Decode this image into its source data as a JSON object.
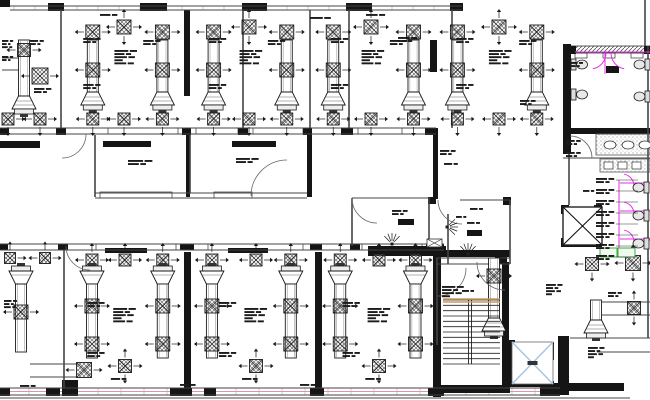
{
  "drawing": {
    "canvas": {
      "w": 650,
      "h": 400,
      "background": "#ffffff"
    },
    "colors": {
      "ink": "#1a1a1a",
      "wall": "#151515",
      "line": "#444444",
      "thin": "#777777",
      "magenta": "#e82de8",
      "green": "#3fa54a",
      "greenFill": "#effaef",
      "elevatorBlue": "#a9c6e4",
      "tan": "#c79b62",
      "pink": "#e48fb4",
      "hatch": "#6a6a6a",
      "stipple": "#999999",
      "white": "#ffffff"
    },
    "plan": {
      "blackRects": [
        [
          0,
          0,
          10,
          7
        ],
        [
          48,
          3,
          16,
          8
        ],
        [
          140,
          3,
          27,
          8
        ],
        [
          242,
          3,
          25,
          8
        ],
        [
          346,
          3,
          26,
          8
        ],
        [
          450,
          3,
          13,
          8
        ],
        [
          184,
          10,
          6,
          86
        ],
        [
          563,
          44,
          8,
          110
        ],
        [
          430,
          40,
          7,
          32
        ],
        [
          0,
          128,
          9,
          7
        ],
        [
          56,
          128,
          10,
          7
        ],
        [
          182,
          128,
          9,
          7
        ],
        [
          238,
          128,
          10,
          7
        ],
        [
          303,
          128,
          9,
          7
        ],
        [
          341,
          128,
          12,
          7
        ],
        [
          425,
          128,
          11,
          7
        ],
        [
          0,
          141,
          40,
          7
        ],
        [
          103,
          141,
          48,
          6
        ],
        [
          232,
          141,
          44,
          6
        ],
        [
          186,
          135,
          4,
          62
        ],
        [
          307,
          133,
          5,
          64
        ],
        [
          433,
          128,
          5,
          71
        ],
        [
          368,
          246,
          78,
          10
        ],
        [
          428,
          197,
          8,
          7
        ],
        [
          503,
          197,
          8,
          8
        ],
        [
          495,
          255,
          12,
          9
        ],
        [
          0,
          244,
          8,
          6
        ],
        [
          58,
          244,
          10,
          6
        ],
        [
          180,
          244,
          14,
          6
        ],
        [
          310,
          244,
          12,
          6
        ],
        [
          350,
          244,
          10,
          6
        ],
        [
          426,
          244,
          18,
          6
        ],
        [
          105,
          248,
          42,
          5
        ],
        [
          228,
          248,
          40,
          5
        ],
        [
          184,
          252,
          7,
          136
        ],
        [
          315,
          252,
          7,
          140
        ],
        [
          433,
          250,
          8,
          147
        ],
        [
          433,
          250,
          77,
          7
        ],
        [
          502,
          262,
          7,
          130
        ],
        [
          436,
          385,
          74,
          8
        ],
        [
          508,
          340,
          7,
          46
        ],
        [
          508,
          381,
          46,
          6
        ],
        [
          510,
          342,
          18,
          5
        ],
        [
          547,
          342,
          7,
          18
        ],
        [
          558,
          336,
          11,
          59
        ],
        [
          540,
          383,
          84,
          8
        ],
        [
          561,
          205,
          8,
          9
        ],
        [
          594,
          205,
          8,
          9
        ],
        [
          561,
          238,
          8,
          9
        ],
        [
          563,
          240,
          39,
          7
        ],
        [
          563,
          128,
          87,
          6
        ],
        [
          0,
          388,
          10,
          8
        ],
        [
          46,
          388,
          14,
          8
        ],
        [
          62,
          380,
          16,
          16
        ],
        [
          170,
          388,
          22,
          8
        ],
        [
          204,
          388,
          12,
          8
        ],
        [
          310,
          388,
          14,
          8
        ],
        [
          428,
          388,
          16,
          8
        ],
        [
          540,
          388,
          20,
          8
        ],
        [
          570,
          46,
          6,
          8
        ],
        [
          644,
          46,
          6,
          8
        ],
        [
          606,
          66,
          13,
          7
        ],
        [
          398,
          219,
          16,
          6
        ],
        [
          467,
          230,
          15,
          6
        ]
      ],
      "hatchRects": [
        [
          570,
          46,
          80,
          7
        ]
      ],
      "vlines": [
        [
          61,
          10,
          128
        ],
        [
          243,
          10,
          128
        ],
        [
          310,
          10,
          128
        ],
        [
          349,
          10,
          128
        ],
        [
          452,
          10,
          128
        ],
        [
          95,
          135,
          197
        ],
        [
          190,
          135,
          193
        ],
        [
          64,
          250,
          388
        ],
        [
          429,
          198,
          246
        ],
        [
          352,
          198,
          246
        ],
        [
          448,
          214,
          264
        ],
        [
          510,
          200,
          264
        ],
        [
          569,
          152,
          205
        ],
        [
          648,
          46,
          338
        ],
        [
          645,
          0,
          46
        ],
        [
          437,
          258,
          345
        ]
      ],
      "hlines": [
        [
          10,
          6,
          462
        ],
        [
          10,
          10,
          462
        ],
        [
          0,
          128,
          436
        ],
        [
          0,
          134,
          436
        ],
        [
          95,
          193,
          307
        ],
        [
          95,
          198,
          307
        ],
        [
          352,
          198,
          430
        ],
        [
          460,
          200,
          510
        ],
        [
          436,
          258,
          510
        ],
        [
          436,
          264,
          510
        ],
        [
          0,
          244,
          444
        ],
        [
          0,
          250,
          444
        ],
        [
          0,
          388,
          560
        ],
        [
          0,
          395,
          560
        ],
        [
          0,
          398,
          630
        ],
        [
          563,
          158,
          650
        ],
        [
          596,
          134,
          650
        ],
        [
          570,
          338,
          650
        ],
        [
          597,
          352,
          650
        ],
        [
          602,
          302,
          650
        ],
        [
          602,
          315,
          650
        ],
        [
          30,
          364,
          78
        ],
        [
          30,
          377,
          78
        ],
        [
          2,
          58,
          20
        ],
        [
          2,
          70,
          20
        ]
      ],
      "pinkLines": [
        [
          0,
          391.5,
          560
        ]
      ],
      "tickRuns": [
        {
          "y1": 6,
          "y2": 10,
          "x1": 14,
          "x2": 458,
          "step": 21
        },
        {
          "y1": 388,
          "y2": 395,
          "x1": 6,
          "x2": 554,
          "step": 23
        }
      ],
      "windowRects": [
        [
          108,
          128,
          70,
          6
        ],
        [
          196,
          128,
          42,
          6
        ],
        [
          253,
          128,
          50,
          6
        ],
        [
          358,
          128,
          44,
          6
        ],
        [
          96,
          244,
          80,
          6
        ],
        [
          208,
          244,
          95,
          6
        ],
        [
          362,
          244,
          60,
          6
        ],
        [
          100,
          192,
          72,
          6
        ],
        [
          214,
          192,
          38,
          6
        ],
        [
          575,
          53,
          12,
          5
        ],
        [
          603,
          53,
          12,
          5
        ],
        [
          631,
          53,
          12,
          5
        ]
      ],
      "topRooms": [
        {
          "x": 64,
          "w": 120,
          "ducts": [
            0.24,
            0.82
          ]
        },
        {
          "x": 190,
          "w": 118,
          "ducts": [
            0.2,
            0.82
          ]
        },
        {
          "x": 312,
          "w": 118,
          "ducts": [
            0.18,
            0.86
          ]
        },
        {
          "x": 436,
          "w": 126,
          "ducts": [
            0.17,
            0.8
          ]
        }
      ],
      "bottomRooms": [
        {
          "x": 66,
          "w": 118,
          "ducts": [
            0.22,
            0.82
          ]
        },
        {
          "x": 198,
          "w": 116,
          "ducts": [
            0.12,
            0.8
          ]
        },
        {
          "x": 322,
          "w": 114,
          "ducts": [
            0.16,
            0.82
          ]
        }
      ],
      "ducts": [
        {
          "cx": 24,
          "y1": 40,
          "y2": 96,
          "hood": "down"
        },
        {
          "cx": 494,
          "y1": 258,
          "y2": 318,
          "hood": "down"
        },
        {
          "cx": 596,
          "y1": 300,
          "y2": 320,
          "hood": "down"
        },
        {
          "cx": 21,
          "y1": 284,
          "y2": 352,
          "hood": "up"
        }
      ],
      "diffusers": [
        {
          "x": 24,
          "y": 50,
          "s": 13,
          "a": [
            "l",
            "r"
          ]
        },
        {
          "x": 40,
          "y": 76,
          "s": 16,
          "a": [
            "l",
            "r"
          ]
        },
        {
          "x": 8,
          "y": 119,
          "s": 12,
          "a": [
            "r",
            "d"
          ]
        },
        {
          "x": 40,
          "y": 119,
          "s": 12,
          "a": [
            "l",
            "r",
            "d"
          ]
        },
        {
          "x": 10,
          "y": 258,
          "s": 11,
          "a": [
            "r",
            "u"
          ]
        },
        {
          "x": 45,
          "y": 258,
          "s": 11,
          "a": [
            "l",
            "r",
            "u"
          ]
        },
        {
          "x": 21,
          "y": 312,
          "s": 14,
          "a": [
            "l",
            "r"
          ]
        },
        {
          "x": 84,
          "y": 370,
          "s": 15,
          "a": [
            "l",
            "r"
          ]
        },
        {
          "x": 494,
          "y": 276,
          "s": 14,
          "a": [
            "l",
            "r"
          ]
        },
        {
          "x": 592,
          "y": 264,
          "s": 13,
          "a": [
            "l",
            "r",
            "d"
          ]
        },
        {
          "x": 633,
          "y": 263,
          "s": 15,
          "a": [
            "l",
            "r",
            "u",
            "d"
          ]
        },
        {
          "x": 634,
          "y": 308,
          "s": 13,
          "a": [
            "u",
            "d"
          ]
        }
      ],
      "doorArcs": [
        {
          "cx": 90,
          "cy": 246,
          "r": 24,
          "a1": 90,
          "a2": 180
        },
        {
          "cx": 287,
          "cy": 196,
          "r": 36,
          "a1": 180,
          "a2": 270
        },
        {
          "cx": 377,
          "cy": 198,
          "r": 25,
          "a1": 90,
          "a2": 180
        },
        {
          "cx": 462,
          "cy": 200,
          "r": 24,
          "a1": 90,
          "a2": 180
        },
        {
          "cx": 505,
          "cy": 262,
          "r": 28,
          "a1": 90,
          "a2": 180
        },
        {
          "cx": 438,
          "cy": 268,
          "r": 28,
          "a1": 0,
          "a2": 90
        },
        {
          "cx": 570,
          "cy": 158,
          "r": 22,
          "a1": 270,
          "a2": 360
        },
        {
          "cx": 62,
          "cy": 134,
          "r": 24,
          "a1": 0,
          "a2": 90
        }
      ],
      "magentaLines": [
        [
          575,
          52,
          650,
          52
        ],
        [
          605,
          53,
          605,
          74
        ],
        [
          619,
          180,
          619,
          256
        ],
        [
          620,
          183,
          650,
          183
        ],
        [
          620,
          211,
          650,
          211
        ],
        [
          620,
          239,
          650,
          239
        ],
        [
          634,
          246,
          650,
          240
        ]
      ],
      "magentaArcs": [
        {
          "cx": 590,
          "cy": 53,
          "r": 16,
          "a1": 0,
          "a2": 80
        },
        {
          "cx": 627,
          "cy": 53,
          "r": 16,
          "a1": 100,
          "a2": 180
        },
        {
          "cx": 622,
          "cy": 186,
          "r": 12,
          "a1": 280,
          "a2": 360
        },
        {
          "cx": 622,
          "cy": 214,
          "r": 12,
          "a1": 280,
          "a2": 360
        },
        {
          "cx": 622,
          "cy": 242,
          "r": 12,
          "a1": 280,
          "a2": 360
        }
      ],
      "toilets": [
        {
          "x": 571,
          "y": 58,
          "dir": "r"
        },
        {
          "x": 571,
          "y": 88,
          "dir": "r"
        },
        {
          "x": 633,
          "y": 181,
          "dir": "l"
        },
        {
          "x": 633,
          "y": 209,
          "dir": "l"
        },
        {
          "x": 633,
          "y": 237,
          "dir": "l"
        },
        {
          "x": 634,
          "y": 58,
          "dir": "l"
        },
        {
          "x": 634,
          "y": 90,
          "dir": "l"
        }
      ],
      "counters": [
        [
          596,
          134,
          54,
          21
        ],
        [
          600,
          159,
          50,
          13
        ]
      ],
      "sinks": [
        [
          610,
          145
        ],
        [
          628,
          145
        ],
        [
          645,
          145
        ]
      ],
      "sinkRects": [
        [
          604,
          162,
          9,
          7
        ],
        [
          618,
          162,
          9,
          7
        ],
        [
          632,
          162,
          9,
          7
        ]
      ],
      "greenRects": [
        [
          600,
          248,
          17,
          9
        ],
        [
          618,
          248,
          17,
          9
        ]
      ],
      "stairs": {
        "x": 443,
        "y": 300,
        "w": 57,
        "h": 64,
        "n": 12,
        "s1": 468.5,
        "s2": 471.5,
        "tanY": [
          299,
          302
        ]
      },
      "elevator": {
        "x": 512,
        "y": 342,
        "w": 41,
        "h": 42
      },
      "shaftX": {
        "x": 563,
        "y": 207,
        "w": 39,
        "h": 38
      },
      "xBoxes": [
        {
          "x": 427,
          "y": 239,
          "w": 15,
          "h": 8
        }
      ],
      "rays": [
        {
          "x": 447,
          "y": 227,
          "d": 0
        },
        {
          "x": 468,
          "y": 254,
          "d": 270
        },
        {
          "x": 392,
          "y": 244,
          "d": 270
        }
      ],
      "textBlocks": [
        [
          2,
          40,
          11,
          3
        ],
        [
          2,
          56,
          11,
          2
        ],
        [
          30,
          40,
          14,
          2
        ],
        [
          34,
          88,
          18,
          2
        ],
        [
          100,
          14,
          18,
          1
        ],
        [
          310,
          17,
          22,
          1
        ],
        [
          366,
          14,
          20,
          1
        ],
        [
          398,
          37,
          20,
          2
        ],
        [
          520,
          100,
          16,
          2
        ],
        [
          128,
          160,
          26,
          2
        ],
        [
          236,
          158,
          24,
          2
        ],
        [
          440,
          150,
          16,
          2
        ],
        [
          444,
          163,
          14,
          1
        ],
        [
          392,
          210,
          16,
          2
        ],
        [
          470,
          208,
          13,
          1
        ],
        [
          467,
          222,
          13,
          1
        ],
        [
          456,
          216,
          10,
          1
        ],
        [
          462,
          290,
          12,
          1
        ],
        [
          546,
          284,
          17,
          4
        ],
        [
          442,
          286,
          23,
          4
        ],
        [
          588,
          347,
          17,
          4
        ],
        [
          608,
          292,
          14,
          2
        ],
        [
          566,
          140,
          15,
          2
        ],
        [
          566,
          152,
          15,
          2
        ],
        [
          583,
          190,
          11,
          1
        ],
        [
          570,
          62,
          13,
          2
        ],
        [
          4,
          300,
          13,
          3
        ],
        [
          20,
          385,
          16,
          1
        ],
        [
          180,
          384,
          16,
          1
        ],
        [
          300,
          384,
          16,
          1
        ]
      ],
      "leaderStack": {
        "x": 596,
        "y0": 178,
        "dy": 11,
        "n": 8,
        "w": 19,
        "lead": 23
      }
    }
  }
}
